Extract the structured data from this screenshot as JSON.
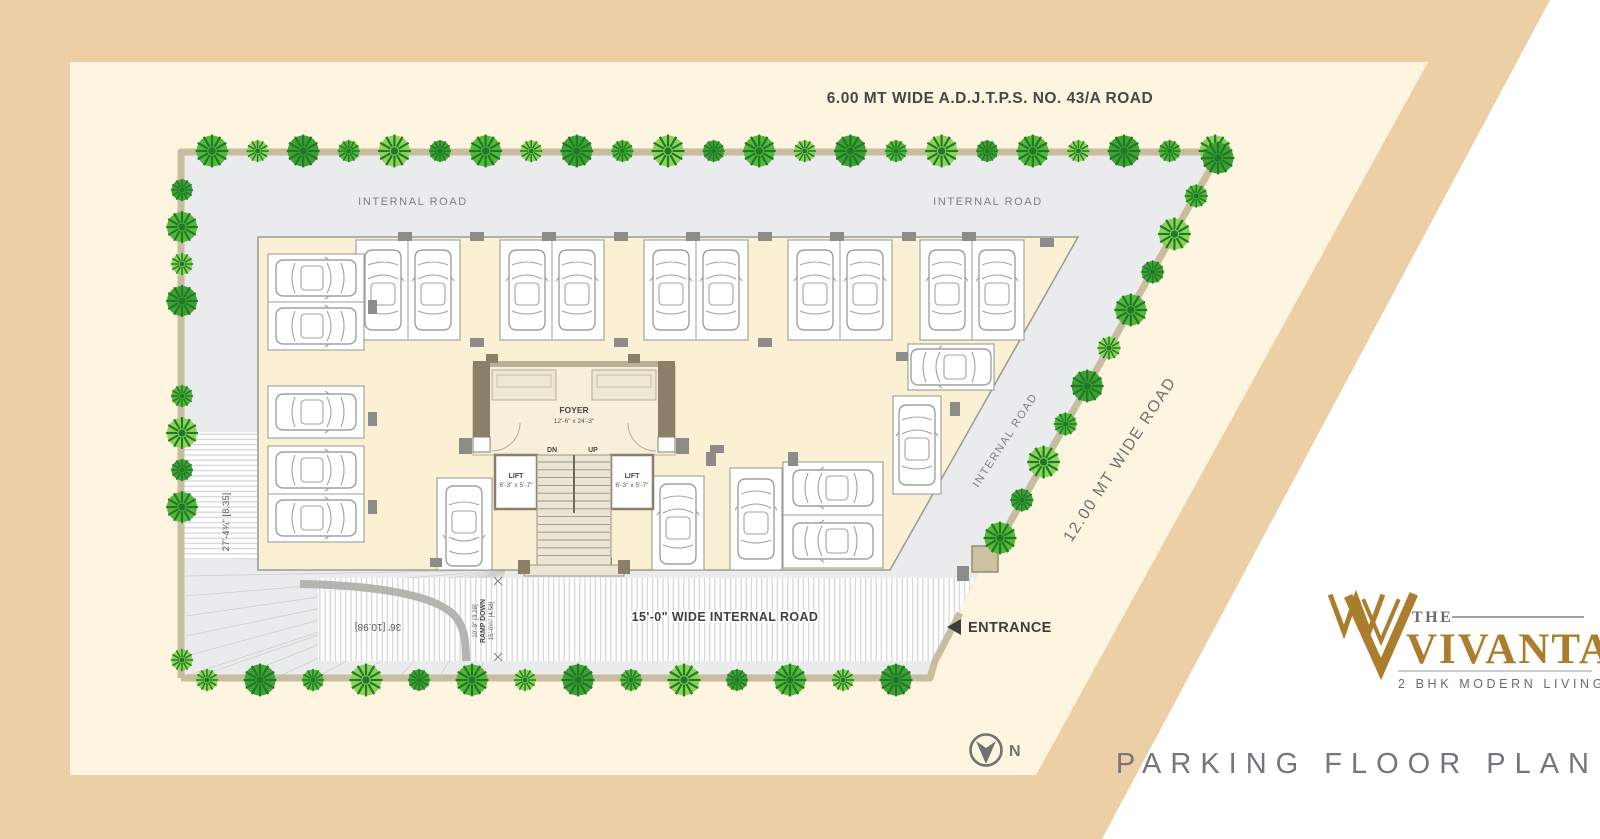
{
  "title": "PARKING FLOOR PLAN",
  "logo": {
    "the": "THE",
    "name": "VIVANTA",
    "tagline": "2 BHK MODERN LIVING"
  },
  "compass": {
    "north": "N"
  },
  "roads": {
    "top": "6.00 MT WIDE A.D.J.T.P.S. NO. 43/A ROAD",
    "internal": "INTERNAL ROAD",
    "right": "12.00 MT WIDE ROAD",
    "bottom": "15'-0\" WIDE INTERNAL ROAD",
    "entrance": "ENTRANCE"
  },
  "dims": {
    "left_strip": "27'-4¾\" [8.35]",
    "ramp_width": "36' [10.98]",
    "ramp_lane_1": "10'-9\" [3.28]",
    "ramp_lane_2": "RAMP DOWN",
    "ramp_lane_3": "15'-0¼\" [4.58]"
  },
  "core": {
    "foyer": "FOYER",
    "foyer_dim": "12'-6\" x 24'-3\"",
    "dn": "DN",
    "up": "UP",
    "lift": "LIFT",
    "lift_dim": "6'-3\" x 5'-7\""
  },
  "colors": {
    "band_tan": "#eccfa5",
    "page_cream": "#fdf5e0",
    "road_gray": "#e9ebec",
    "floor_cream": "#faf0d4",
    "boundary_tan": "#c8bd9e",
    "wall_dark": "#8a7f6b",
    "tree_green": "#55b837",
    "logo_gold": "#ab7d2c",
    "text_gray": "#74767a"
  }
}
